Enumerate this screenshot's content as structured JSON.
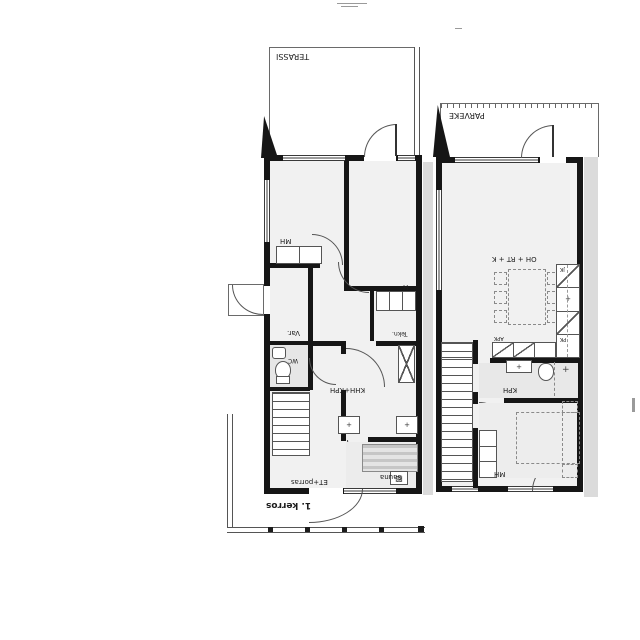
{
  "drawing": {
    "floor1": {
      "floor_label": "1. kerros",
      "terrace": "TERASSI",
      "bedroom": "MH",
      "room_h": "H",
      "storage": "Var.",
      "wc": "WC",
      "tech": "Tekn.",
      "utility_bath": "KHH+KPH",
      "entry_stairs": "ET+porras",
      "sauna": "Sauna"
    },
    "floor2": {
      "balcony": "PARVEKE",
      "living_dining_kitchen": "OH + RT + K",
      "bathroom": "KPH",
      "bedroom": "MH",
      "fridge": "JK",
      "freezer": "PK",
      "dishwasher": "APK"
    },
    "symbols": {
      "cross": "+",
      "stove": "▨"
    },
    "colors": {
      "wall": "#161616",
      "interior": "#f1f1f1",
      "wet_room": "#e6e6e6",
      "adjacent_unit": "#dbdbdb",
      "line": "#555555"
    }
  }
}
